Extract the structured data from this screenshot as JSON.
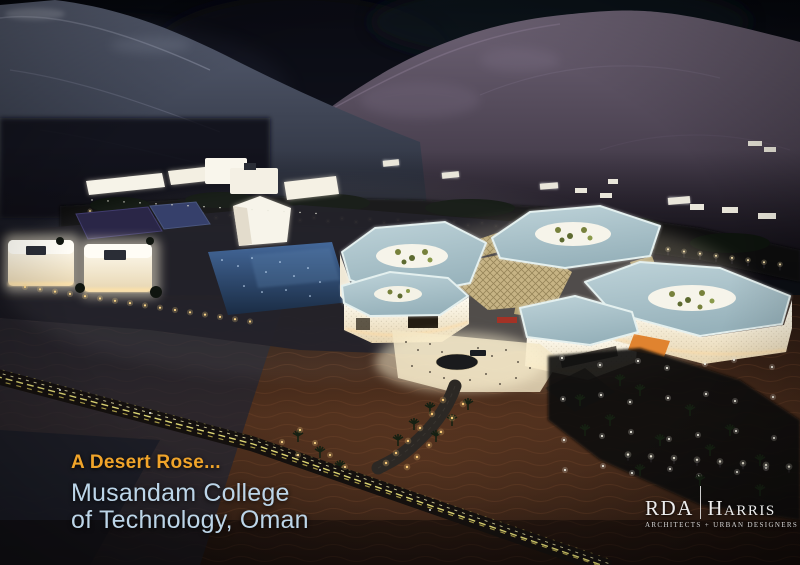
{
  "caption": {
    "tagline": "A Desert Rose...",
    "title_line1": "Musandam College",
    "title_line2": "of Technology, Oman"
  },
  "logo": {
    "firm_left": "RDA",
    "firm_right": "Harris",
    "subtitle": "ARCHITECTS + URBAN DESIGNERS"
  },
  "colors": {
    "tagline_orange": "#F0A42A",
    "title_blue": "#BCD5E8",
    "logo_white": "#EDEDED",
    "roof_blue": "#A9C4CB",
    "lattice_gold": "#C6B384",
    "desert_brown": "#3F2619",
    "accent_orange_building": "#E0832F"
  }
}
